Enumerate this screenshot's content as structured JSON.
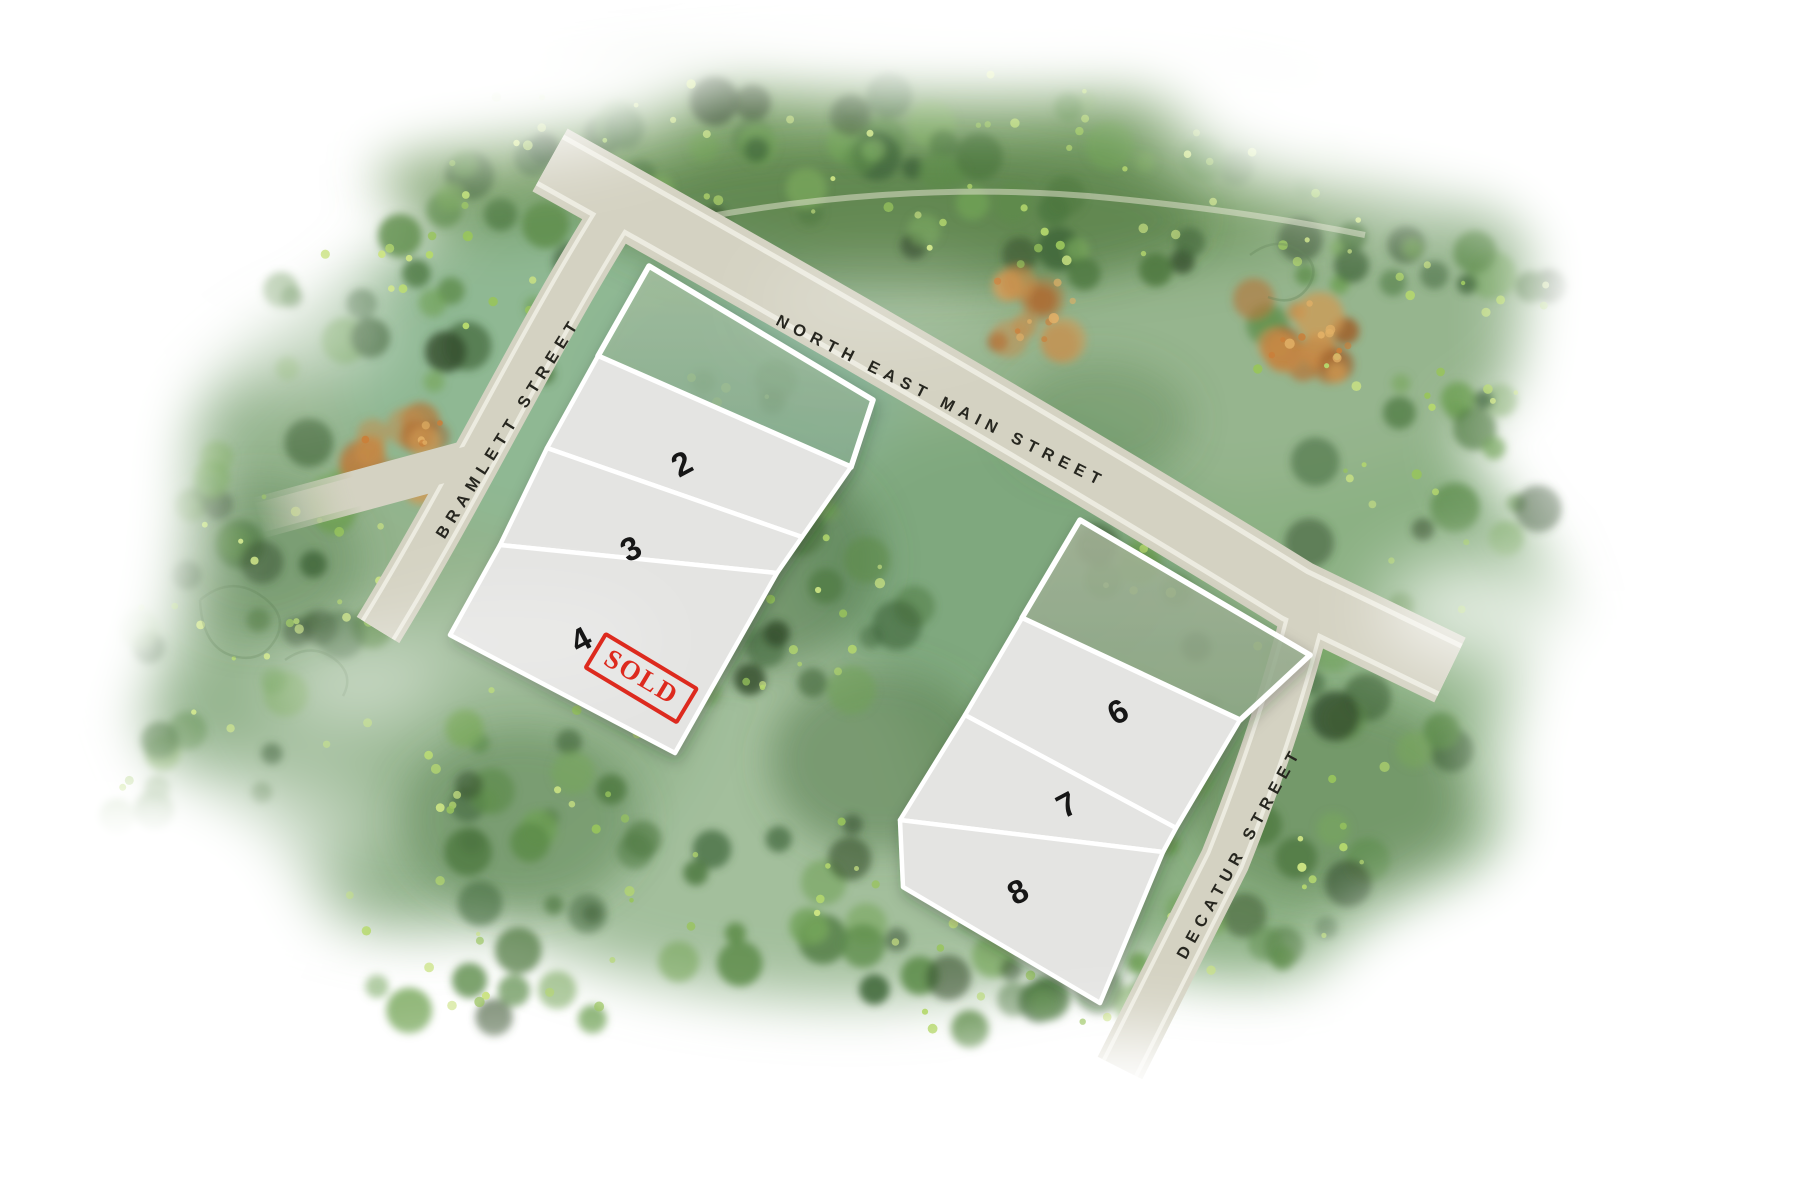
{
  "streets": {
    "main": "NORTH EAST MAIN STREET",
    "bramlett": "BRAMLETT STREET",
    "decatur": "DECATUR STREET"
  },
  "lots": [
    {
      "label": "2",
      "sold": false
    },
    {
      "label": "3",
      "sold": false
    },
    {
      "label": "4",
      "sold": true
    },
    {
      "label": "6",
      "sold": false
    },
    {
      "label": "7",
      "sold": false
    },
    {
      "label": "8",
      "sold": false
    }
  ],
  "stamp_text": "SOLD",
  "colors": {
    "road": "#d4d2c2",
    "curb": "#ecebe0",
    "lot_fill": "#e4e4e2",
    "lot_outline": "#ffffff",
    "sold_red": "#dd2a1e"
  }
}
